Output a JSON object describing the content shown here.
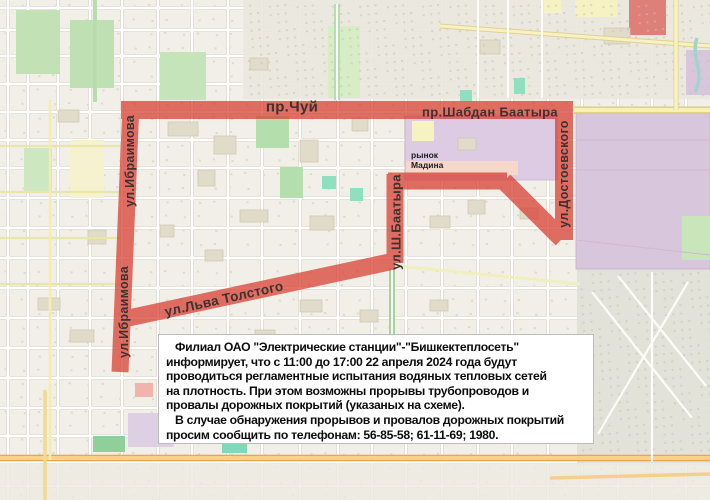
{
  "map": {
    "route_color": "#d93a2e",
    "street_labels": {
      "chuy": "пр.Чуй",
      "shabdan": "пр.Шабдан Баатыра",
      "ibraimova": "ул.Ибраимова",
      "dostoevsky": "ул.Достоевского",
      "sh_baatyra": "ул.Ш.Баатыра",
      "tolstogo": "ул.Льва Толстого"
    },
    "poi_labels": {
      "madina_market": "рынок Мадина"
    }
  },
  "notice": {
    "lines": [
      "Филиал ОАО \"Электрические станции\"-\"Бишкектеплосеть\"",
      "информирует, что с 11:00 до 17:00 22 апреля 2024 года будут",
      "проводиться регламентные испытания водяных тепловых сетей",
      "на плотность. При этом возможны прорывы трубопроводов и",
      "провалы дорожных покрытий (указаных на схеме).",
      "В случае обнаружения прорывов и провалов дорожных покрытий",
      "просим сообщить по телефонам: 56-85-58; 61-11-69; 1980."
    ]
  }
}
